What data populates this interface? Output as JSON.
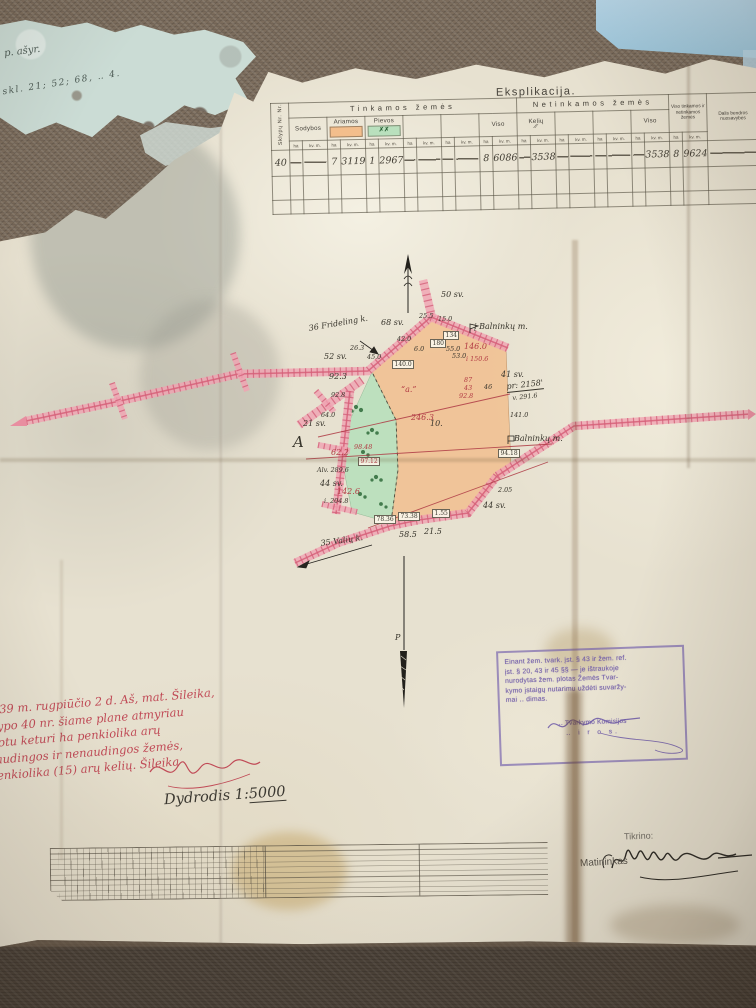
{
  "colors": {
    "paper": "#e7e1d0",
    "fabric": "#7b6c5c",
    "fabric_dark": "#4a4138",
    "sky": "#a9cfe0",
    "teal_fragment": "#cbdcd5",
    "roadband": "#f0a3b2",
    "roadline": "#d65f78",
    "roadtick": "#cf5670",
    "orange": "#f3be8c",
    "green": "#b9e0bd",
    "tree": "#2e6b3a",
    "redink": "#c04a56",
    "stamp_purple": "#6d59a8",
    "ink": "#38352c"
  },
  "note_fragment": {
    "line1": "p. ašyr.",
    "line2": "skl. 21; 52; 68, ‥ 4."
  },
  "table": {
    "title": "Eksplikacija.",
    "col_nr": "Sklypų Nr. Nr.",
    "group_tinkamos": "Tinkamos žemės",
    "group_netinkamos": "Netinkamos žemės",
    "keliu_mark": "∕∕",
    "sub": {
      "sodybos": "Sodybos",
      "ariamos": "Ariamos",
      "pievos": "Pievos",
      "viso": "Viso",
      "keliu": "Kelių",
      "viso2": "Viso",
      "viso_total": "Viso tinkamos ir netinkamos žemės",
      "dalis": "Dalis bendros nuosavybės"
    },
    "units": {
      "ha": "ha",
      "kvm": "kv. m."
    },
    "row": {
      "nr": "40",
      "ariamos_ha": "7",
      "ariamos_kvm": "3119",
      "pievos_ha": "1",
      "pievos_kvm": "2967",
      "viso_ha": "8",
      "viso_kvm": "6086",
      "keliu_kvm": "3538",
      "netinkamos_viso_kvm": "3538",
      "total_ha": "8",
      "total_kvm": "9624"
    }
  },
  "map": {
    "labels": [
      {
        "t": "50 sv.",
        "x": 441,
        "y": 290
      },
      {
        "t": "68 sv.",
        "x": 381,
        "y": 318
      },
      {
        "t": "36 Frideling k.",
        "x": 308,
        "y": 324,
        "r": -10
      },
      {
        "t": "52 sv.",
        "x": 324,
        "y": 352
      },
      {
        "t": "92.3",
        "x": 329,
        "y": 372
      },
      {
        "t": "42.0",
        "x": 397,
        "y": 335,
        "s": 1
      },
      {
        "t": "25.5",
        "x": 419,
        "y": 312,
        "s": 1
      },
      {
        "t": "15.0",
        "x": 438,
        "y": 315,
        "s": 1
      },
      {
        "t": "134",
        "x": 443,
        "y": 331,
        "b": 1
      },
      {
        "t": "180",
        "x": 430,
        "y": 339,
        "b": 1
      },
      {
        "t": "55.0",
        "x": 446,
        "y": 345,
        "s": 1
      },
      {
        "t": "53.0",
        "x": 452,
        "y": 352,
        "s": 1
      },
      {
        "t": "146.0",
        "x": 464,
        "y": 342,
        "c": "r"
      },
      {
        "t": "i 150.6",
        "x": 466,
        "y": 355,
        "c": "r",
        "s": 1
      },
      {
        "t": "į Balninkų m.",
        "x": 474,
        "y": 322
      },
      {
        "t": "140.0",
        "x": 392,
        "y": 360,
        "b": 1
      },
      {
        "t": "26.3",
        "x": 350,
        "y": 344,
        "s": 1
      },
      {
        "t": "45.0",
        "x": 367,
        "y": 353,
        "s": 1
      },
      {
        "t": "6.0",
        "x": 414,
        "y": 345,
        "s": 1
      },
      {
        "t": "“a.”",
        "x": 401,
        "y": 385,
        "c": "r"
      },
      {
        "t": "246.3",
        "x": 411,
        "y": 413,
        "c": "r"
      },
      {
        "t": "10.",
        "x": 430,
        "y": 419
      },
      {
        "t": "87",
        "x": 464,
        "y": 376,
        "c": "r",
        "s": 1
      },
      {
        "t": "43",
        "x": 464,
        "y": 384,
        "c": "r",
        "s": 1
      },
      {
        "t": "92.8",
        "x": 459,
        "y": 392,
        "c": "r",
        "s": 1
      },
      {
        "t": "46",
        "x": 484,
        "y": 383,
        "s": 1
      },
      {
        "t": "41 sv.",
        "x": 501,
        "y": 370
      },
      {
        "t": "pr: 2158'",
        "x": 506,
        "y": 382,
        "u": 1,
        "r": -6
      },
      {
        "t": "v. 291.6",
        "x": 512,
        "y": 394,
        "r": -6,
        "s": 1
      },
      {
        "t": "141.0",
        "x": 510,
        "y": 411,
        "s": 1
      },
      {
        "t": "Balninkų m.",
        "x": 514,
        "y": 434
      },
      {
        "t": "94.18",
        "x": 498,
        "y": 449,
        "b": 1
      },
      {
        "t": "2.05",
        "x": 498,
        "y": 486,
        "s": 1
      },
      {
        "t": "44 sv.",
        "x": 483,
        "y": 501
      },
      {
        "t": "21 sv.",
        "x": 303,
        "y": 419
      },
      {
        "t": "64.0",
        "x": 321,
        "y": 411,
        "s": 1
      },
      {
        "t": "A",
        "x": 293,
        "y": 433,
        "g": 1
      },
      {
        "t": "92.8",
        "x": 331,
        "y": 391,
        "s": 1
      },
      {
        "t": "62.2",
        "x": 331,
        "y": 448,
        "c": "r"
      },
      {
        "t": "98.48",
        "x": 354,
        "y": 443,
        "c": "r",
        "s": 1
      },
      {
        "t": "97.12",
        "x": 358,
        "y": 457,
        "c": "r",
        "b": 1
      },
      {
        "t": "Alv. 289.6",
        "x": 317,
        "y": 466,
        "s": 1
      },
      {
        "t": "44 sv.",
        "x": 320,
        "y": 479
      },
      {
        "t": "142.6",
        "x": 337,
        "y": 487,
        "c": "r"
      },
      {
        "t": "i. 204.8",
        "x": 324,
        "y": 497,
        "s": 1
      },
      {
        "t": "78.36",
        "x": 374,
        "y": 515,
        "b": 1
      },
      {
        "t": "73.38",
        "x": 398,
        "y": 512,
        "b": 1
      },
      {
        "t": "1.55",
        "x": 432,
        "y": 509,
        "b": 1
      },
      {
        "t": "58.5",
        "x": 399,
        "y": 530
      },
      {
        "t": "21.5",
        "x": 424,
        "y": 527
      },
      {
        "t": "35 Valių k.",
        "x": 320,
        "y": 539,
        "r": -8
      },
      {
        "t": "P",
        "x": 395,
        "y": 633
      }
    ]
  },
  "red_note": {
    "lines": [
      "939 m. rugpiūčio 2 d. Aš, mat. Šileika,",
      "lypo 40 nr. šiame plane atmyriau",
      "lotu keturi ha penkiolika arų",
      "audingos ir nenaudingos žemės,",
      "enkiolika (15) arų kelių. Šileika"
    ],
    "sig": "Šileika"
  },
  "scale": {
    "prefix": "Dydrodis 1:",
    "value": "5000"
  },
  "stamp": {
    "lines": [
      "Einant žem. tvark. įst. § 43 ir žem. ref.",
      "įst. § 20, 43 ir 45 §§ — je ištraukoje",
      "nurodytas žem. plotas Žemės Tvar-",
      "kymo įstaigų nutarimu uždėti suvaržy-",
      "mai ‥ dimas."
    ],
    "sig": "P. Kmin",
    "org": "‥ Tvarkymo Komisijos",
    "city": "‥ i r o s."
  },
  "footer": {
    "tikrino": "Tikrino:",
    "matininkas": "Matininkas"
  }
}
